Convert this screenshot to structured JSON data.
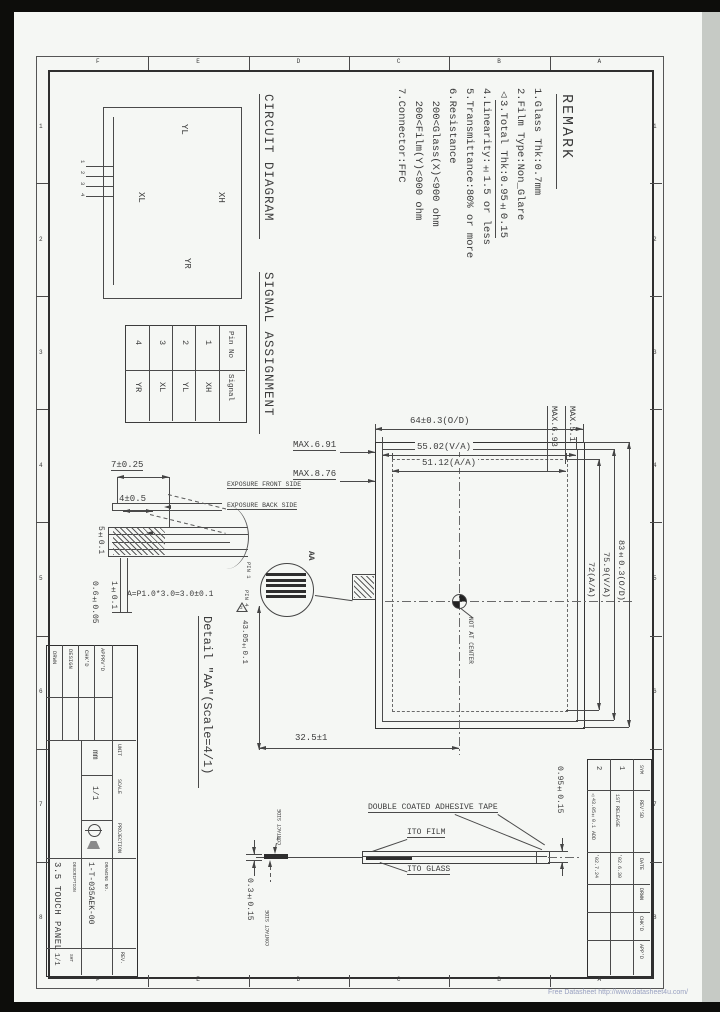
{
  "watermark": "Free Datasheet http://www.datasheet4u.com/",
  "remark": {
    "title": "REMARK",
    "items": [
      "1.Glass Thk:0.7mm",
      "2.Film Type:Non_Glare",
      "3.Total Thk:0.95±0.15",
      "4.Linearity:±1.5 or less",
      "5.Transmittance:80% or more",
      "6.Resistance",
      "  200<Glass(X)<900 ohm",
      "  200<Film(Y)<900 ohm",
      "7.Connector:FFC"
    ]
  },
  "circuit": {
    "title": "CIRCUIT DIAGRAM",
    "xh": "XH",
    "yl": "YL",
    "xl": "XL",
    "yr": "YR",
    "pins": [
      "1",
      "2",
      "3",
      "4"
    ]
  },
  "signal": {
    "title": "SIGNAL ASSIGNMENT",
    "pin_header": "Pin No",
    "signal_header": "Signal",
    "pins": [
      "1",
      "2",
      "3",
      "4"
    ],
    "signals": [
      "XH",
      "YL",
      "XL",
      "YR"
    ]
  },
  "dims": {
    "od_w": "64±0.3(O/D)",
    "va_w": "55.02(V/A)",
    "aa_w": "51.12(A/A)",
    "max691": "MAX.6.91",
    "max876": "MAX.8.76",
    "max693": "MAX.6.93",
    "max51": "MAX.5.1",
    "od_h": "83±0.3(O/D)",
    "va_h": "75.9(V/A)",
    "aa_h": "72(A/A)",
    "d325": "32.5±1",
    "d43": "43.05±0.1",
    "d7": "7±0.25",
    "d4": "4±0.5",
    "d5": "5±0.1",
    "d1": "1±0.1",
    "d06": "0.6±0.05",
    "d095": "0.95±0.15",
    "d03": "0.3±0.15"
  },
  "notes": {
    "front": "EXPOSURE FRONT SIDE",
    "back": "EXPOSURE BACK SIDE",
    "center": "NOT AT CENTER",
    "pitch": "A=P1.0*3.0=3.0±0.1",
    "pin1": "PIN 1",
    "pin4": "PIN 4",
    "section": "AA",
    "detail_title": "Detail \"AA\"(Scale=4/1)",
    "marker2": "2",
    "tri": "△"
  },
  "stackup": {
    "tape": "DOUBLE COATED ADHESIVE TAPE",
    "film": "ITO FILM",
    "glass": "ITO GLASS",
    "contact_top": "CONTACT SIDE",
    "contact_bottom": "CONTACT SIDE"
  },
  "titleblock": {
    "signoff": [
      "DRWN",
      "DESIGN",
      "CHK'D",
      "APPRV'D"
    ],
    "unit_label": "UNIT",
    "unit_value": "mm",
    "scale_label": "SCALE",
    "scale_value": "1/1",
    "proj_label": "PROJECTION",
    "desc_label": "DESCRIPTION",
    "description": "3.5 TOUCH PANEL",
    "dwg_label": "DRAWING NO.",
    "dwg_no": "1-T-035AEK-00",
    "sht_label": "SHT",
    "sht_value": "1/1",
    "rev_label": "REV."
  },
  "revtable": {
    "headers": [
      "SYM",
      "REV'SD",
      "DATE",
      "DRWN",
      "CHK'D",
      "APP'D"
    ],
    "rows": [
      {
        "no": "1",
        "desc": "1ST RELEASE",
        "date": "'02.6.30"
      },
      {
        "no": "2",
        "desc": "△43.05±0.1 ADD",
        "date": "'02.7.24"
      }
    ]
  },
  "zones": {
    "numbers": [
      "1",
      "2",
      "3",
      "4",
      "5",
      "6",
      "7",
      "8"
    ],
    "letters": [
      "F",
      "E",
      "D",
      "C",
      "B",
      "A"
    ]
  }
}
